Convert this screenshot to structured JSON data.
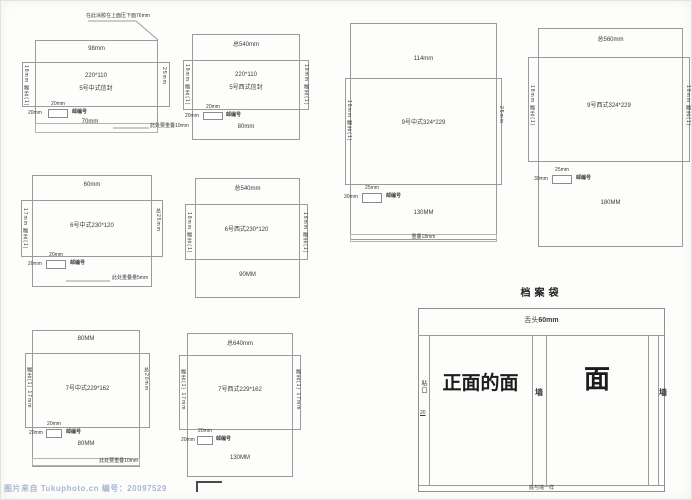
{
  "envelopes": {
    "cn5_chinese": {
      "glue_note": "在此涂胶在上面压下面76mm",
      "flap_top": "98mm",
      "size": "220*110",
      "name": "5号中式信封",
      "left_tab": "18mm 糊舌(1)",
      "right_tab": "25mm",
      "postal_width": "20mm",
      "postal_height": "20mm",
      "postal_label": "邮编号",
      "body_width": "70mm",
      "overlap_note": "此处要重叠10mm"
    },
    "cn5_western": {
      "total": "总540mm",
      "size": "220*110",
      "name": "5号西式信封",
      "left_tab": "18mm 糊舌(1)",
      "right_tab": "18mm 糊舌(1)",
      "postal_width": "20mm",
      "postal_height": "20mm",
      "postal_label": "邮编号",
      "flap_bottom": "80mm"
    },
    "cn6_chinese": {
      "flap_top": "60mm",
      "label": "6号中式230*120",
      "left_tab": "17mm 糊舌(1)",
      "right_tab": "总25mm",
      "postal_width": "20mm",
      "postal_height": "20mm",
      "postal_label": "邮编号",
      "overlap_note": "此处重叠量5mm"
    },
    "cn6_western": {
      "total": "总540mm",
      "label": "6号西式230*120",
      "left_tab": "18mm 糊舌(1)",
      "right_tab": "18mm 糊舌(1)",
      "flap_bottom": "90MM"
    },
    "cn7_chinese": {
      "flap_top": "80MM",
      "label": "7号中式229*162",
      "left_tab": "糊舌(1) 17mm",
      "right_tab": "总20mm",
      "postal_width": "20mm",
      "postal_height": "20mm",
      "postal_label": "邮编号",
      "flap_bottom": "80MM",
      "overlap_note": "此处要重叠10mm"
    },
    "cn7_western": {
      "total": "总640mm",
      "label": "7号西式229*162",
      "left_tab": "糊舌(1) 17mm",
      "right_tab": "糊舌(1) 17mm",
      "postal_width": "20mm",
      "postal_height": "20mm",
      "postal_label": "邮编号",
      "flap_bottom": "130MM"
    },
    "cn9_chinese": {
      "flap_top": "114mm",
      "label": "9号中式324*229",
      "left_tab": "18mm 糊舌(1)",
      "right_tab": "25mm",
      "postal_width": "25mm",
      "postal_height": "30mm",
      "postal_label": "邮编号",
      "flap_bottom": "130MM",
      "overlap_note": "重叠18mm"
    },
    "cn9_western": {
      "total": "总560mm",
      "label": "9号西式324*229",
      "left_tab": "18mm 糊舌(1)",
      "right_tab": "18mm 糊舌(1)",
      "postal_width": "25mm",
      "postal_height": "30mm",
      "postal_label": "邮编号",
      "flap_bottom": "180MM"
    }
  },
  "archive_bag": {
    "title": "档案袋",
    "tongue_prefix": "舌头",
    "tongue_size": "60mm",
    "glue_label": "粘口",
    "glue_size": "20",
    "front_panel": "正面的面",
    "wall_left": "墙",
    "face_panel": "面",
    "wall_right": "墙",
    "bottom_note": "底与墙一样"
  },
  "watermark": "图片来自 Tukuphoto.cn 编号：20097529"
}
